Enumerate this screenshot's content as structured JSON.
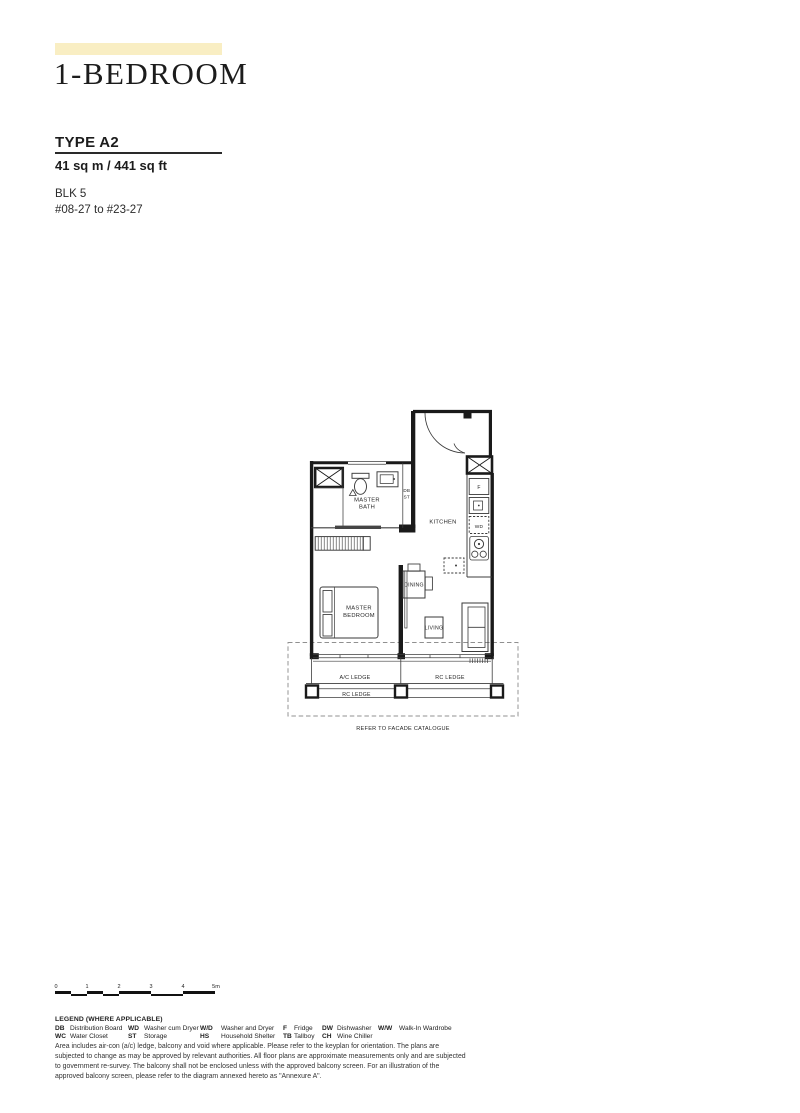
{
  "header": {
    "title": "1-BEDROOM",
    "type_label": "TYPE A2",
    "area": "41 sq m / 441 sq ft",
    "block": "BLK 5",
    "unit_range": "#08-27 to #23-27"
  },
  "floorplan": {
    "labels": {
      "master_bath_1": "MASTER",
      "master_bath_2": "BATH",
      "master_bedroom_1": "MASTER",
      "master_bedroom_2": "BEDROOM",
      "kitchen": "KITCHEN",
      "dining": "DINING",
      "living": "LIVING",
      "db": "DB",
      "st": "ST",
      "fridge": "F",
      "washer_dryer": "WD",
      "ac_ledge": "A/C LEDGE",
      "rc_ledge_right": "RC LEDGE",
      "rc_ledge_bottom": "RC LEDGE",
      "facade_note": "REFER TO FACADE CATALOGUE"
    }
  },
  "scale_bar": {
    "ticks": [
      "0",
      "1",
      "2",
      "3",
      "4",
      "5m"
    ]
  },
  "legend": {
    "title": "LEGEND (WHERE APPLICABLE)",
    "items": [
      {
        "abbr": "DB",
        "desc": "Distribution Board"
      },
      {
        "abbr": "WC",
        "desc": "Water Closet"
      },
      {
        "abbr": "WD",
        "desc": "Washer cum Dryer"
      },
      {
        "abbr": "ST",
        "desc": "Storage"
      },
      {
        "abbr": "W/D",
        "desc": "Washer and Dryer"
      },
      {
        "abbr": "HS",
        "desc": "Household Shelter"
      },
      {
        "abbr": "F",
        "desc": "Fridge"
      },
      {
        "abbr": "TB",
        "desc": "Tallboy"
      },
      {
        "abbr": "DW",
        "desc": "Dishwasher"
      },
      {
        "abbr": "CH",
        "desc": "Wine Chiller"
      },
      {
        "abbr": "W/W",
        "desc": "Walk-In Wardrobe"
      }
    ]
  },
  "disclaimer": "Area includes air-con (a/c) ledge, balcony and void where applicable. Please refer to the keyplan for orientation. The plans are subjected to change as may be approved by relevant authorities. All floor plans are approximate measurements only and are subjected to government re-survey. The balcony shall not be enclosed unless with the approved balcony screen. For an illustration of the approved balcony screen, please refer to the diagram annexed hereto as \"Annexure A\".",
  "colors": {
    "accent_yellow": "#f9eec3",
    "ink": "#1c1c1c",
    "wall": "#1a1a1a",
    "dash_gray": "#909090"
  }
}
